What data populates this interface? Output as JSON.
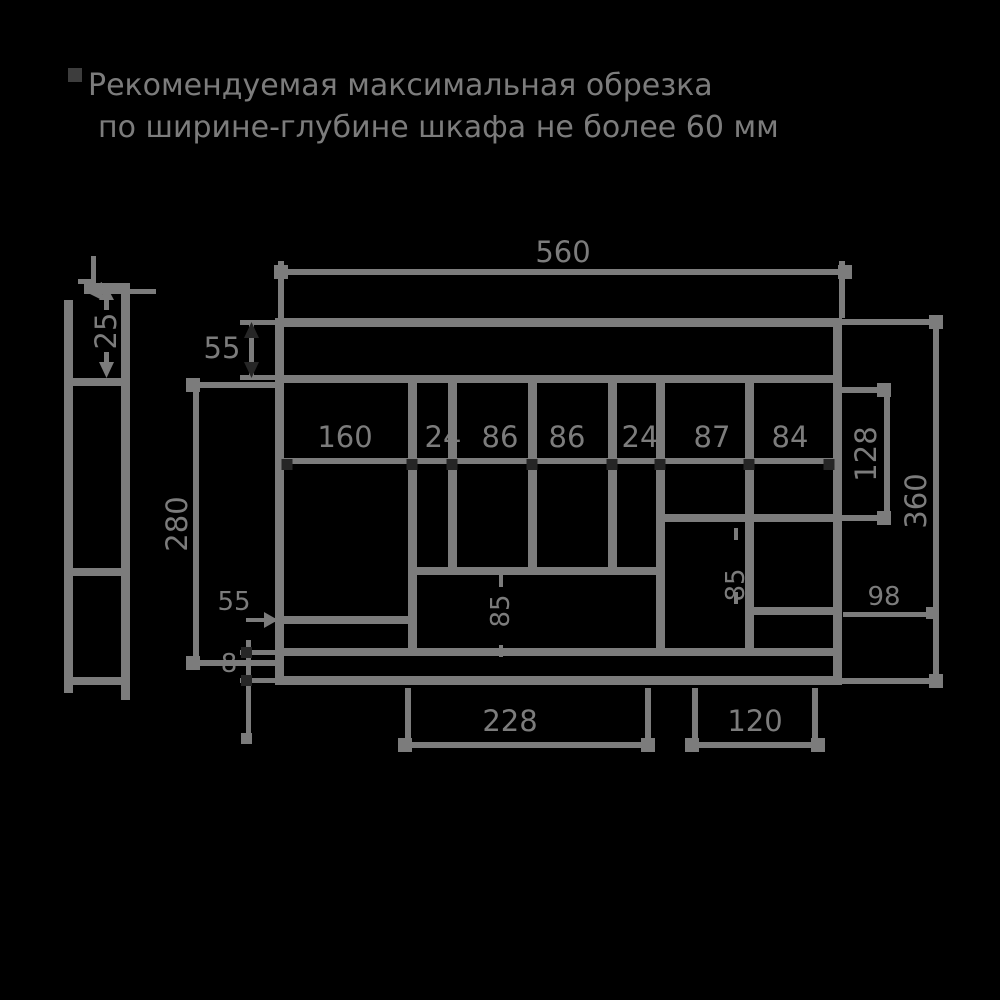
{
  "note": {
    "bullet": "▪",
    "line1": "Рекомендуемая максимальная обрезка",
    "line2": "по ширине-глубине шкафа не более 60 мм"
  },
  "side_view": {
    "height_25": "25"
  },
  "front_view": {
    "width_top": "560",
    "top_band": "55",
    "heights": {
      "outer_right": "360",
      "inner_right": "128",
      "inner_left": "280"
    },
    "widths_row": [
      "160",
      "24",
      "86",
      "86",
      "24",
      "87",
      "84"
    ],
    "bottom": {
      "left_width": "228",
      "right_width": "120",
      "panel": "8",
      "right_gap": "98",
      "left_shelf": "55"
    },
    "inner_vertical": {
      "left": "85",
      "right": "85"
    }
  },
  "colors": {
    "background": "#000000",
    "line": "#7c7c7c",
    "dark_mark": "#262626"
  }
}
